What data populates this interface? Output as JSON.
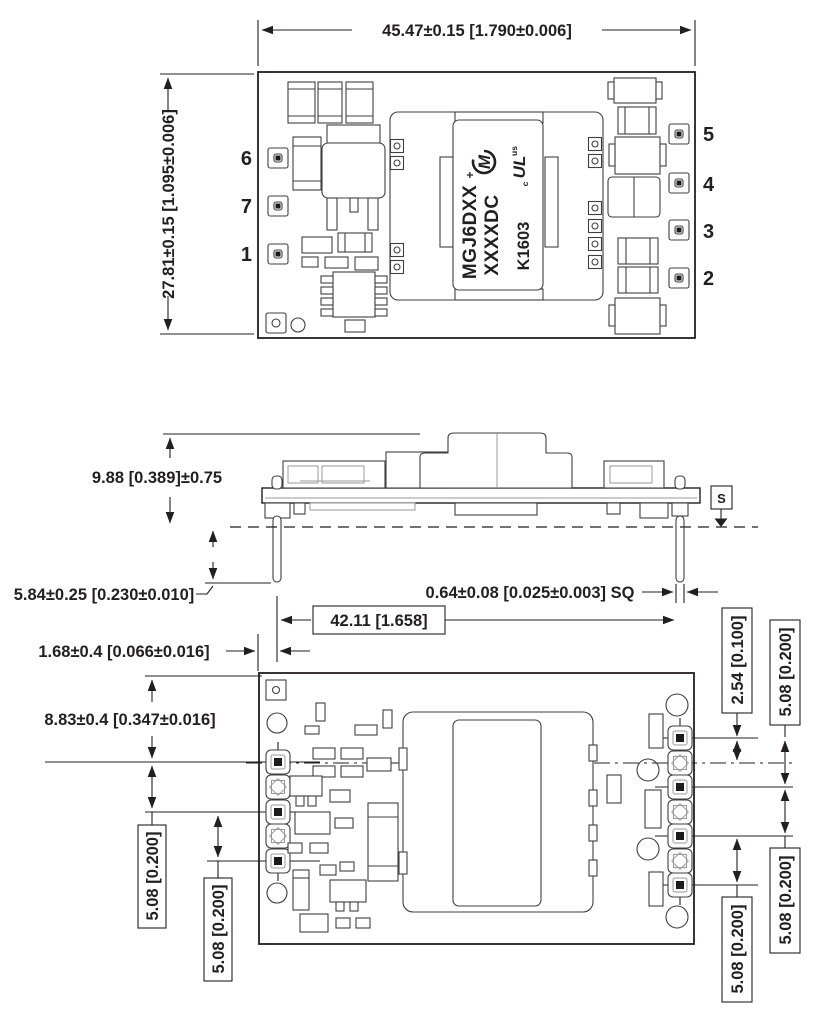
{
  "drawing": {
    "top_view": {
      "width_dim": "45.47±0.15 [1.790±0.006]",
      "height_dim": "27.81±0.15 [1.095±0.006]",
      "pins_left": [
        "6",
        "7",
        "1"
      ],
      "pins_right": [
        "5",
        "4",
        "3",
        "2"
      ],
      "module_label_line1": "MGJ6DXX",
      "module_label_line2": "XXXXDC",
      "module_label_line3": "K1603",
      "murata_logo_letter": "M",
      "murata_logo_plus": "+",
      "ul_mark": "UL",
      "ul_mark_c": "c",
      "ul_mark_us": "us"
    },
    "side_view": {
      "height_dim": "9.88 [0.389]±0.75",
      "pin_length_dim": "5.84±0.25 [0.230±0.010]",
      "pin_size_dim": "0.64±0.08 [0.025±0.003] SQ",
      "pin_span_dim": "42.11 [1.658]",
      "edge_offset_dim": "1.68±0.4 [0.066±0.016]",
      "seating_plane_symbol": "S"
    },
    "bottom_view": {
      "top_offset_dim": "8.83±0.4 [0.347±0.016]",
      "pitch_small_dim": "2.54 [0.100]",
      "pitch_dim": "5.08 [0.200]"
    },
    "colors": {
      "line": "#231f20",
      "background": "#ffffff"
    }
  }
}
